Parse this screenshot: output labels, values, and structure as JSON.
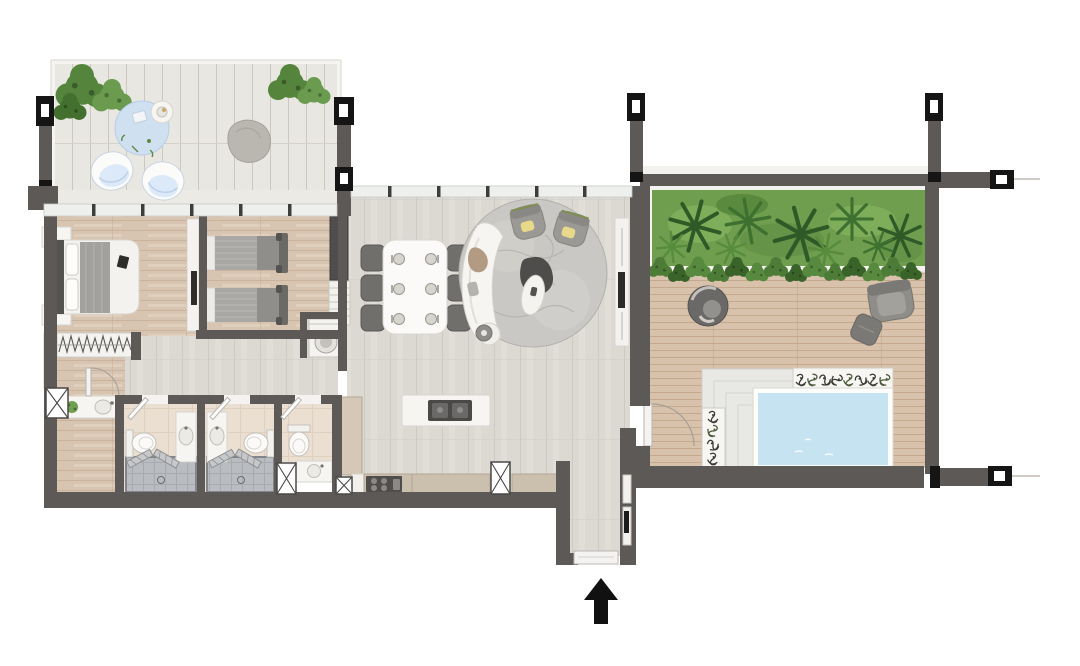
{
  "meta": {
    "kind": "architectural floor plan, top-down 2D color render",
    "text_labels_visible": "none",
    "canvas": {
      "width_px": 1080,
      "height_px": 666
    }
  },
  "colors": {
    "background": "#ffffff",
    "wall": "#5d5956",
    "wall_cut_marker": "#151515",
    "window_band": "#eef0ed",
    "mullion": "#3d3d3b",
    "deck_plank": "#e9e7e1",
    "bedroom_wood": "#d8c5b1",
    "living_wood": "#dcd9d3",
    "terrace_wood": "#d8c2ab",
    "bathroom_tile": "#ebdfd1",
    "shower_tile": "#b9bcc0",
    "pool_water": "#c6e3f2",
    "pool_coping": "#ffffff",
    "planting_green": "#6f9e4e",
    "palm_green_dark": "#2e5a27",
    "shrub_green": "#4c7c37",
    "rug_blue": "#cfe0f1",
    "rug_gray": "#cac8c4",
    "furniture_white": "#f6f5f2",
    "furniture_gray": "#8f8d89",
    "furniture_dark": "#4a4947",
    "counter_beige": "#cbbfae",
    "accent_pillow_yellow": "#e8d98a",
    "accent_trim_green": "#7f8f4f",
    "throw_brown": "#b39a83"
  },
  "rooms": [
    {
      "id": "roof-deck",
      "area": "top-left",
      "floor": "white timber deck, vertical planks"
    },
    {
      "id": "master-bedroom",
      "area": "left",
      "floor": "oak wood"
    },
    {
      "id": "second-bedroom",
      "area": "center-left",
      "floor": "oak wood"
    },
    {
      "id": "dressing-area",
      "area": "lower-left",
      "floor": "oak wood"
    },
    {
      "id": "hallway",
      "area": "center",
      "floor": "grey wood"
    },
    {
      "id": "bathroom-1",
      "area": "bottom-left",
      "floor": "beige tile + grey shower"
    },
    {
      "id": "bathroom-2",
      "area": "bottom-left",
      "floor": "beige tile + grey shower"
    },
    {
      "id": "powder-room",
      "area": "bottom-center",
      "floor": "beige tile"
    },
    {
      "id": "laundry-niche",
      "area": "center",
      "floor": "grey"
    },
    {
      "id": "living-dining-room",
      "area": "center",
      "floor": "grey wood"
    },
    {
      "id": "kitchen",
      "area": "bottom-center",
      "floor": "grey wood"
    },
    {
      "id": "entry-hall",
      "area": "bottom-center",
      "floor": "grey wood"
    },
    {
      "id": "pool-terrace",
      "area": "right",
      "floor": "tan timber deck, horizontal planks"
    }
  ],
  "furniture": {
    "roof_deck": [
      "corner-shrub-planting",
      "corner-shrub-planting",
      "round-blue-outdoor-rug",
      "round-side-table-with-tray",
      "lounge-chair",
      "lounge-chair",
      "round-grey-daybed-pouf"
    ],
    "master_bedroom": [
      "double-bed-white-duvet-grey-throw",
      "headboard",
      "nightstand-with-lamp",
      "nightstand-with-lamp",
      "book-on-bed"
    ],
    "dressing_area": [
      "wardrobe-hanging-clothes-symbol",
      "tall-shelving-strip",
      "vanity-counter-with-sink",
      "potted-plant",
      "door-swing-arc",
      "service-shaft-x-box"
    ],
    "second_bedroom": [
      "twin-bed",
      "twin-bed",
      "media-partition-with-tv",
      "dark-wardrobe",
      "open-shelf-unit"
    ],
    "laundry_niche": [
      "washing-machine"
    ],
    "bathroom_1": [
      "toilet",
      "vanity-with-sink",
      "walk-in-shower",
      "folding-shower-screens",
      "floor-drain",
      "door-leaf"
    ],
    "bathroom_2": [
      "vanity-with-sink",
      "toilet",
      "walk-in-shower",
      "folding-shower-screens",
      "floor-drain",
      "door-leaf"
    ],
    "powder_room": [
      "toilet",
      "vanity-with-sink",
      "door-leaf",
      "service-shaft-x-box",
      "service-shaft-x-box"
    ],
    "living_dining": [
      "dining-table",
      "dining-chairs-x6",
      "place-settings-x6",
      "round-textured-rug",
      "curved-white-sofa",
      "brown-throw",
      "armchair-with-yellow-pillow",
      "armchair-with-yellow-pillow",
      "organic-coffee-table-dark",
      "oval-marble-side-table",
      "mini-side-table",
      "tv-media-panel-with-tv"
    ],
    "kitchen": [
      "island-with-cooktop",
      "tall-cabinet",
      "range-stove-4-burners",
      "counter-run-beige",
      "counter-run-beige",
      "service-shaft-x-box"
    ],
    "entry_hall": [
      "entry-door-threshold",
      "built-in-wall-cabinet"
    ],
    "pool_terrace": [
      "palm-planting-bed",
      "shrub-hedge-row",
      "round-swivel-chair",
      "armchair",
      "ottoman",
      "stepped-timber-platform",
      "plunge-pool",
      "planter-box-horizontal",
      "planter-box-vertical",
      "door-swing-arc"
    ]
  },
  "symbols": {
    "entry_arrow": {
      "shape": "solid black arrow pointing up",
      "meaning": "main entrance below entry door"
    },
    "wall_cut_markers": {
      "shape": "black H-shaped section symbols on wall stubs",
      "count": 6,
      "locations": [
        "top-left",
        "deck-right-wall top",
        "deck-right-wall bottom",
        "terrace top-left stub",
        "terrace top-right stub",
        "right-edge horizontal stubs"
      ]
    },
    "service_shafts": {
      "shape": "white box with diagonal X",
      "count": 4
    },
    "door_swings": {
      "shape": "quarter-circle arc with white leaf",
      "count": 5
    },
    "window_bands": {
      "shape": "white glazing band with dark mullion ticks",
      "count": 2
    }
  }
}
